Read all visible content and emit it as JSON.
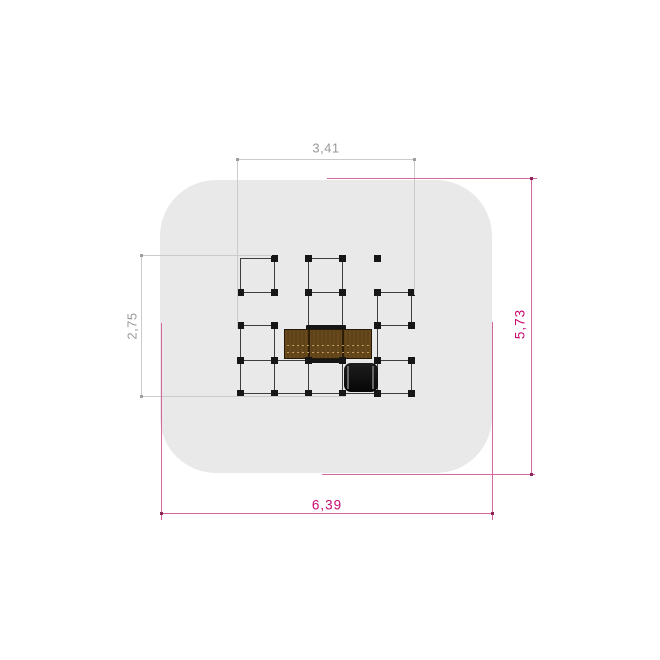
{
  "drawing": {
    "background": "#ffffff",
    "mat": {
      "x": 160,
      "y": 180,
      "w": 332,
      "h": 293,
      "radius": 56,
      "fill": "#e9e9e9"
    },
    "dim_styles": {
      "gray": {
        "line": "#cbcbcb",
        "text": "#9a9a9a",
        "dot": "#9f9f9f"
      },
      "magenta": {
        "line": "#d4679e",
        "text": "#cb0a70",
        "dot": "#8c2558"
      }
    },
    "dims": [
      {
        "id": "structure-width",
        "label": "3,41",
        "color": "gray",
        "line": [
          237.5,
          159,
          414.5,
          159
        ],
        "exts": [
          [
            237.5,
            159,
            237.5,
            329
          ],
          [
            414.5,
            159,
            414.5,
            295
          ]
        ],
        "label_pos": [
          326,
          148
        ],
        "rotate": 0
      },
      {
        "id": "structure-height",
        "label": "2,75",
        "color": "gray",
        "line": [
          141.5,
          255,
          141.5,
          396.5
        ],
        "exts": [
          [
            141.5,
            255,
            272,
            255
          ],
          [
            141.5,
            396.5,
            346,
            396.5
          ]
        ],
        "label_pos": [
          132,
          325.5
        ],
        "rotate": -90
      },
      {
        "id": "area-height",
        "label": "5,73",
        "color": "magenta",
        "line": [
          531.5,
          178,
          531.5,
          474
        ],
        "exts": [
          [
            326.5,
            178,
            536.5,
            178
          ],
          [
            322,
            474,
            534.5,
            474
          ]
        ],
        "label_pos": [
          520,
          323.5
        ],
        "rotate": -90
      },
      {
        "id": "area-width",
        "label": "6,39",
        "color": "magenta",
        "line": [
          161,
          513.5,
          492.5,
          513.5
        ],
        "exts": [
          [
            161,
            323,
            161,
            520
          ],
          [
            492.5,
            322,
            492.5,
            519.5
          ]
        ],
        "label_pos": [
          327,
          504.5
        ],
        "rotate": 0
      }
    ],
    "structure": {
      "line_color": "#3d3d3d",
      "lines": [
        [
          240,
          258,
          240,
          292
        ],
        [
          274.5,
          258,
          274.5,
          292
        ],
        [
          308.5,
          258,
          308.5,
          292
        ],
        [
          342.5,
          258,
          342.5,
          292
        ],
        [
          308.5,
          292,
          308.5,
          325.5
        ],
        [
          342.5,
          292,
          342.5,
          325.5
        ],
        [
          377,
          292,
          377,
          325.5
        ],
        [
          411,
          292,
          411,
          325.5
        ],
        [
          240,
          325.5,
          240,
          360
        ],
        [
          274.5,
          325.5,
          274.5,
          360
        ],
        [
          377,
          325.5,
          377,
          360
        ],
        [
          240,
          360,
          240,
          393.5
        ],
        [
          274.5,
          360,
          274.5,
          393.5
        ],
        [
          308.5,
          360,
          308.5,
          393.5
        ],
        [
          342.5,
          360,
          342.5,
          393.5
        ],
        [
          377,
          360,
          377,
          393.5
        ],
        [
          411,
          360,
          411,
          393.5
        ],
        [
          240,
          258,
          274.5,
          258
        ],
        [
          308.5,
          258,
          342.5,
          258
        ],
        [
          240,
          292,
          274.5,
          292
        ],
        [
          308.5,
          292,
          342.5,
          292
        ],
        [
          377,
          292,
          411,
          292
        ],
        [
          240,
          325.5,
          274.5,
          325.5
        ],
        [
          377,
          325.5,
          411,
          325.5
        ],
        [
          240,
          360,
          308.5,
          360
        ],
        [
          377,
          360,
          411,
          360
        ],
        [
          240,
          393.5,
          411,
          393.5
        ]
      ],
      "post_size": 7,
      "post_color": "#161616",
      "posts": [
        [
          274.5,
          258
        ],
        [
          308.5,
          258
        ],
        [
          342.5,
          258
        ],
        [
          377,
          258
        ],
        [
          240,
          292
        ],
        [
          274.5,
          292
        ],
        [
          308.5,
          292
        ],
        [
          342.5,
          292
        ],
        [
          377,
          292
        ],
        [
          411,
          292
        ],
        [
          240,
          325.5
        ],
        [
          274.5,
          325.5
        ],
        [
          377,
          325.5
        ],
        [
          411,
          325.5
        ],
        [
          240,
          360
        ],
        [
          274.5,
          360
        ],
        [
          308.5,
          360
        ],
        [
          342.5,
          360
        ],
        [
          377,
          360
        ],
        [
          411,
          360
        ],
        [
          240,
          393.5
        ],
        [
          274.5,
          393.5
        ],
        [
          308.5,
          393.5
        ],
        [
          342.5,
          393.5
        ],
        [
          377,
          393.5
        ],
        [
          411,
          393.5
        ]
      ],
      "deck": {
        "x": 305.5,
        "y": 324.5,
        "w": 40.5,
        "h": 38,
        "fill": "#151515"
      },
      "platform": {
        "x": 283.5,
        "y": 329,
        "w": 88.5,
        "h": 29.5,
        "fill_a": "#68491c",
        "fill_b": "#5e421a",
        "border": "#241806",
        "dividers": [
          308.5,
          342.5
        ],
        "divider_color": "#2b1d07",
        "dash_rows": [
          345,
          352
        ],
        "dash_color": "rgba(201,164,98,0.9)"
      },
      "tunnel": {
        "x": 344,
        "y": 363,
        "w": 34,
        "h": 28.5,
        "radius": 7,
        "fill_top": "#1e1e1e",
        "fill_bottom": "#060606",
        "stripes": [
          347.5,
          373
        ],
        "stripe_color": "#666666"
      }
    }
  }
}
